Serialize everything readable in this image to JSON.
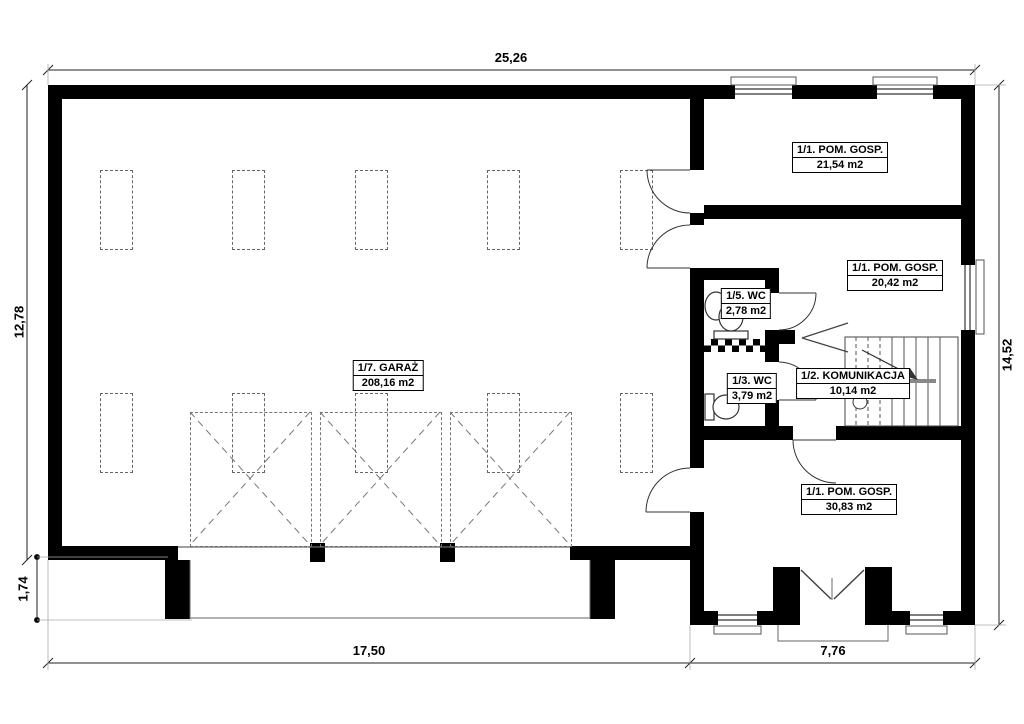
{
  "drawing": {
    "type": "floor-plan",
    "rooms": [
      {
        "id": "garaz",
        "name": "1/7. GARAŻ",
        "area": "208,16 m2"
      },
      {
        "id": "pom-gosp-top",
        "name": "1/1. POM. GOSP.",
        "area": "21,54 m2"
      },
      {
        "id": "pom-gosp-mid",
        "name": "1/1. POM. GOSP.",
        "area": "20,42 m2"
      },
      {
        "id": "wc-5",
        "name": "1/5. WC",
        "area": "2,78 m2"
      },
      {
        "id": "wc-3",
        "name": "1/3. WC",
        "area": "3,79 m2"
      },
      {
        "id": "komunikacja",
        "name": "1/2. KOMUNIKACJA",
        "area": "10,14 m2"
      },
      {
        "id": "pom-gosp-bottom",
        "name": "1/1. POM. GOSP.",
        "area": "30,83 m2"
      }
    ],
    "dimensions": {
      "top_width": "25,26",
      "left_height": "12,78",
      "right_height": "14,52",
      "apron_depth": "1,74",
      "bottom_left_width": "17,50",
      "bottom_right_width": "7,76"
    },
    "symbols": [
      "toilet-icon",
      "washbasin-icon",
      "stairs",
      "door-swing-arc",
      "garage-gate-projection",
      "window-symbol"
    ],
    "colors": {
      "wall": "#000000",
      "line": "#555555",
      "dashed": "#777777",
      "background": "#ffffff",
      "text": "#000000"
    }
  }
}
